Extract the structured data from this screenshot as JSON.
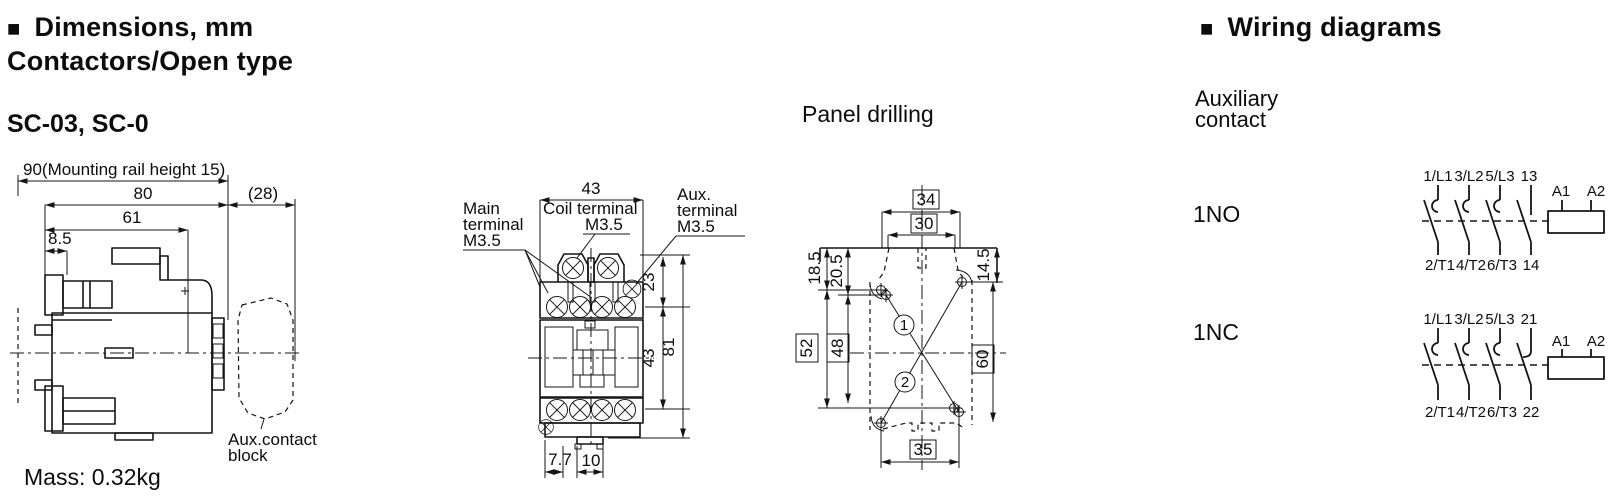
{
  "colors": {
    "ink": "#0c0c0c",
    "background": "#ffffff"
  },
  "header": {
    "bullet": "■",
    "title": "Dimensions, mm",
    "subtitle": "Contactors/Open type",
    "model": "SC-03, SC-0",
    "mass": "Mass: 0.32kg"
  },
  "side": {
    "dim_rail": "90(Mounting rail height 15)",
    "dim_80": "80",
    "dim_61": "61",
    "dim_8_5": "8.5",
    "dim_28": "(28)",
    "aux_label_1": "Aux.contact",
    "aux_label_2": "block"
  },
  "front": {
    "main_terminal": [
      "Main",
      "terminal",
      "M3.5"
    ],
    "coil_terminal": [
      "Coil terminal",
      "M3.5"
    ],
    "aux_terminal": [
      "Aux.",
      "terminal",
      "M3.5"
    ],
    "dim_top": "43",
    "dim_23": "23",
    "dim_43": "43",
    "dim_81": "81",
    "dim_7_7": "7.7",
    "dim_10": "10"
  },
  "panel": {
    "title": "Panel drilling",
    "dim_34": "34",
    "dim_30": "30",
    "dim_18_5": "18.5",
    "dim_20_5": "20.5",
    "dim_14_5": "14.5",
    "dim_52": "52",
    "dim_48": "48",
    "dim_60": "60",
    "dim_35": "35",
    "marker_1": "1",
    "marker_2": "2"
  },
  "wiring": {
    "bullet": "■",
    "title": "Wiring diagrams",
    "subtitle_1": "Auxiliary",
    "subtitle_2": "contact",
    "diagrams": [
      {
        "label": "1NO",
        "top": [
          "1/L1",
          "3/L2",
          "5/L3",
          "13"
        ],
        "coil": [
          "A1",
          "A2"
        ],
        "bottom": [
          "2/T1",
          "4/T2",
          "6/T3",
          "14"
        ]
      },
      {
        "label": "1NC",
        "top": [
          "1/L1",
          "3/L2",
          "5/L3",
          "21"
        ],
        "coil": [
          "A1",
          "A2"
        ],
        "bottom": [
          "2/T1",
          "4/T2",
          "6/T3",
          "22"
        ]
      }
    ]
  }
}
